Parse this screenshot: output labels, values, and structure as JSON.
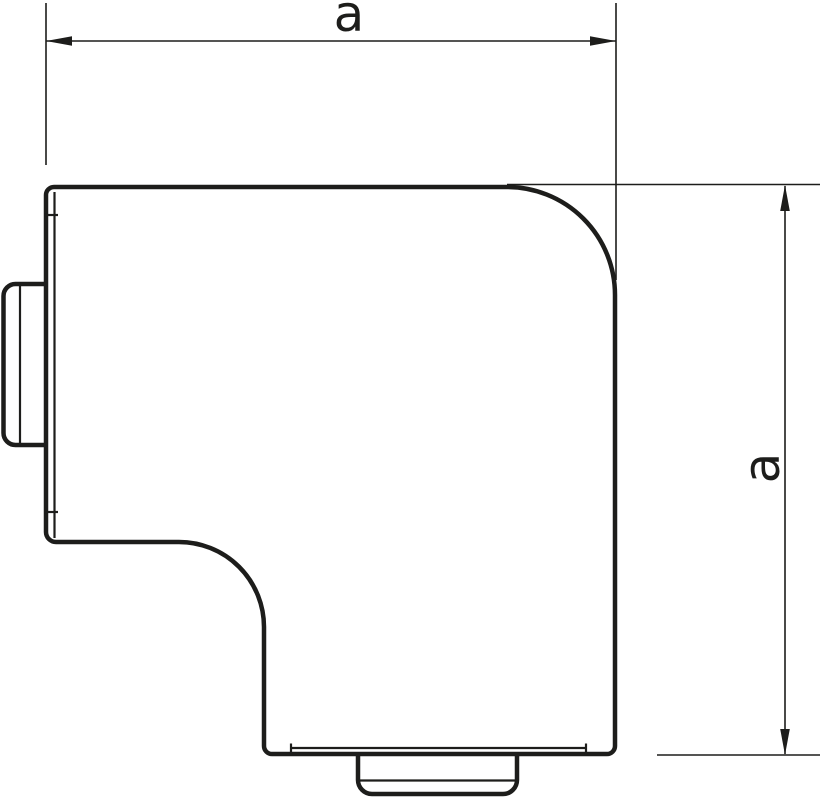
{
  "drawing": {
    "type": "technical-dimension-drawing",
    "part": "flat-angle-corner-piece",
    "width_dimension": {
      "label": "a"
    },
    "height_dimension": {
      "label": "a"
    }
  },
  "colors": {
    "line": "#1d1d1b",
    "background": "#ffffff"
  }
}
